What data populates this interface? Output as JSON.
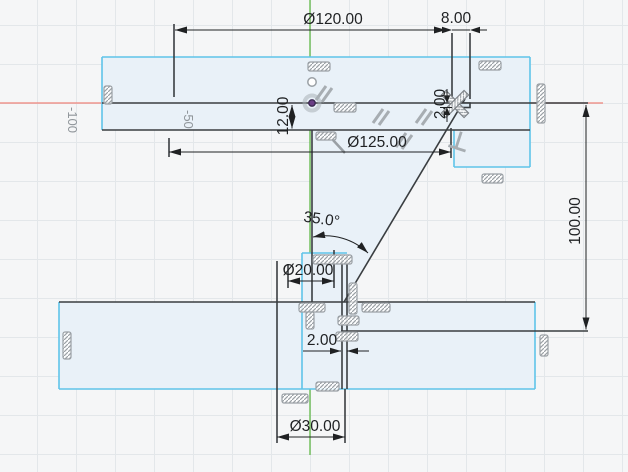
{
  "app": {
    "view": "cad-sketch-canvas"
  },
  "axis_labels": {
    "neg100": "-100",
    "neg50": "-50"
  },
  "dimensions": {
    "dia120": "Ø120.00",
    "len8": "8.00",
    "dia125": "Ø125.00",
    "len12": "12.00",
    "thk2_top": "2.00",
    "angle35": "35.0°",
    "dia20": "Ø20.00",
    "thk2_bottom": "2.00",
    "dia30": "Ø30.00",
    "len100": "100.00"
  },
  "icons": {
    "origin_point": "origin-point",
    "sketch_point": "sketch-point",
    "hatch_box": "constraint-badge",
    "parallel": "parallel-constraint",
    "perpendicular": "perpendicular-constraint",
    "cross": "crossed-constraint"
  },
  "colors": {
    "background": "#f5f6f7",
    "grid_line": "#e3e7ea",
    "x_axis_red": "#ef837a",
    "y_axis_green": "#61b846",
    "sketch_line": "#3a3e41",
    "sketch_edge_cyan": "#5fc4e9",
    "profile_fill": "#e9f1f8",
    "dimension": "#1f2123",
    "constraint_icon": "#9aa0a5",
    "origin_purple": "#6b3f86"
  }
}
